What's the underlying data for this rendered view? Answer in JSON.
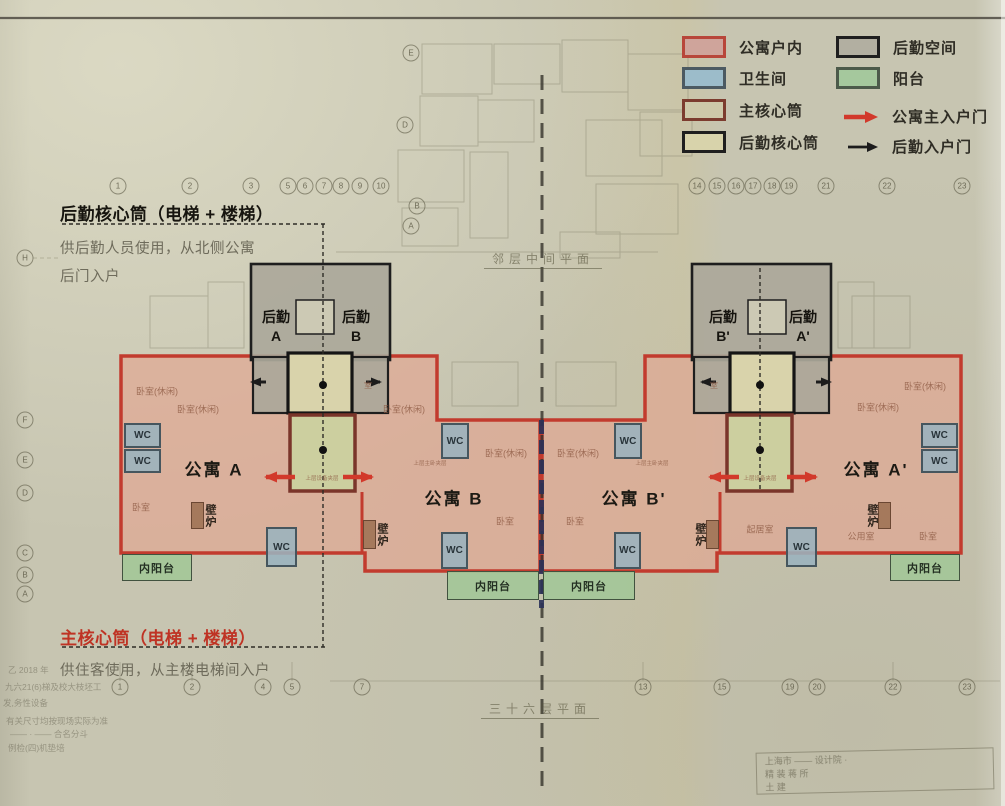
{
  "legend": {
    "items": [
      {
        "name": "apartment-interior",
        "label": "公寓户内",
        "x": 682,
        "y": 36,
        "fill": "#cfa49b",
        "border": "#b8463a"
      },
      {
        "name": "service-space",
        "label": "后勤空间",
        "x": 836,
        "y": 36,
        "fill": "#b2afa1",
        "border": "#1f1f1f"
      },
      {
        "name": "bathroom",
        "label": "卫生间",
        "x": 682,
        "y": 67,
        "fill": "#9cbcca",
        "border": "#4c5a62"
      },
      {
        "name": "balcony",
        "label": "阳台",
        "x": 836,
        "y": 67,
        "fill": "#a5c89d",
        "border": "#4c5a4a"
      },
      {
        "name": "main-core",
        "label": "主核心筒",
        "x": 682,
        "y": 99,
        "fill": "#cec9a9",
        "border": "#7c3c2e"
      },
      {
        "name": "service-core",
        "label": "后勤核心筒",
        "x": 682,
        "y": 131,
        "fill": "#d8d3ab",
        "border": "#1f1f1f"
      }
    ],
    "arrows": [
      {
        "name": "apartment-main-entry",
        "label": "公寓主入户门",
        "x": 843,
        "y": 106,
        "color": "#d2392b",
        "big": true
      },
      {
        "name": "service-entry",
        "label": "后勤入户门",
        "x": 847,
        "y": 136,
        "color": "#1c1c1c",
        "big": false
      }
    ]
  },
  "annotations": {
    "service_core": {
      "title": "后勤核心筒（电梯 + 楼梯）",
      "line1": "供后勤人员使用，从北侧公寓",
      "line2": "后门入户"
    },
    "main_core": {
      "title": "主核心筒（电梯 + 楼梯）",
      "line1": "供住客使用，从主楼电梯间入户"
    }
  },
  "plan": {
    "apartment_labels": [
      {
        "t": "公寓 A",
        "x": 214,
        "y": 468
      },
      {
        "t": "公寓 B",
        "x": 454,
        "y": 497
      },
      {
        "t": "公寓 B'",
        "x": 634,
        "y": 497
      },
      {
        "t": "公寓 A'",
        "x": 876,
        "y": 468
      }
    ],
    "service_labels": [
      {
        "l1": "后勤",
        "l2": "A",
        "x": 276,
        "y": 327
      },
      {
        "l1": "后勤",
        "l2": "B",
        "x": 356,
        "y": 327
      },
      {
        "l1": "后勤",
        "l2": "B'",
        "x": 723,
        "y": 327
      },
      {
        "l1": "后勤",
        "l2": "A'",
        "x": 803,
        "y": 327
      }
    ],
    "wc_label": "WC",
    "wc_boxes": [
      {
        "x": 124,
        "y": 423,
        "w": 37,
        "h": 25
      },
      {
        "x": 124,
        "y": 449,
        "w": 37,
        "h": 24
      },
      {
        "x": 266,
        "y": 527,
        "w": 31,
        "h": 40
      },
      {
        "x": 441,
        "y": 423,
        "w": 28,
        "h": 36
      },
      {
        "x": 441,
        "y": 532,
        "w": 27,
        "h": 37
      },
      {
        "x": 614,
        "y": 423,
        "w": 28,
        "h": 36
      },
      {
        "x": 614,
        "y": 532,
        "w": 27,
        "h": 37
      },
      {
        "x": 921,
        "y": 423,
        "w": 37,
        "h": 25
      },
      {
        "x": 921,
        "y": 449,
        "w": 37,
        "h": 24
      },
      {
        "x": 786,
        "y": 527,
        "w": 31,
        "h": 40
      }
    ],
    "balcony_label": "内阳台",
    "balconies": [
      {
        "x": 122,
        "y": 554,
        "w": 70,
        "h": 27
      },
      {
        "x": 447,
        "y": 571,
        "w": 92,
        "h": 29
      },
      {
        "x": 543,
        "y": 571,
        "w": 92,
        "h": 29
      },
      {
        "x": 890,
        "y": 554,
        "w": 70,
        "h": 27
      }
    ],
    "fireplace_label": "壁炉",
    "fireplaces": [
      {
        "x": 191,
        "y": 502,
        "w": 13,
        "h": 27,
        "tx": 210,
        "ty": 516
      },
      {
        "x": 363,
        "y": 520,
        "w": 13,
        "h": 29,
        "tx": 382,
        "ty": 535
      },
      {
        "x": 706,
        "y": 520,
        "w": 13,
        "h": 29,
        "tx": 700,
        "ty": 535
      },
      {
        "x": 878,
        "y": 502,
        "w": 13,
        "h": 27,
        "tx": 872,
        "ty": 516
      }
    ],
    "room_labels": [
      {
        "t": "卧室(休闲)",
        "x": 157,
        "y": 391
      },
      {
        "t": "卧室(休闲)",
        "x": 198,
        "y": 409
      },
      {
        "t": "卧室",
        "x": 141,
        "y": 507
      },
      {
        "t": "卧室(休闲)",
        "x": 404,
        "y": 409
      },
      {
        "t": "卧室(休闲)",
        "x": 506,
        "y": 453
      },
      {
        "t": "卧室",
        "x": 505,
        "y": 521
      },
      {
        "t": "卧室(休闲)",
        "x": 578,
        "y": 453
      },
      {
        "t": "卧室",
        "x": 575,
        "y": 521
      },
      {
        "t": "起居室",
        "x": 760,
        "y": 529
      },
      {
        "t": "卧室(休闲)",
        "x": 925,
        "y": 386
      },
      {
        "t": "卧室(休闲)",
        "x": 878,
        "y": 407
      },
      {
        "t": "公用室",
        "x": 861,
        "y": 536
      },
      {
        "t": "卧室",
        "x": 928,
        "y": 536
      },
      {
        "t": "上层设备夹层",
        "x": 322,
        "y": 478,
        "s": 5.5
      },
      {
        "t": "上层设备夹层",
        "x": 760,
        "y": 478,
        "s": 5.5
      },
      {
        "t": "上层主卧夹层",
        "x": 430,
        "y": 463,
        "s": 5.5
      },
      {
        "t": "上层主卧夹层",
        "x": 652,
        "y": 463,
        "s": 5.5
      },
      {
        "t": "室",
        "x": 368,
        "y": 385,
        "s": 8,
        "v": true
      },
      {
        "t": "室",
        "x": 714,
        "y": 385,
        "s": 8,
        "v": true
      }
    ],
    "grid_bubbles": [
      {
        "t": "1",
        "x": 118,
        "y": 186
      },
      {
        "t": "2",
        "x": 190,
        "y": 186
      },
      {
        "t": "3",
        "x": 251,
        "y": 186
      },
      {
        "t": "5",
        "x": 288,
        "y": 186
      },
      {
        "t": "6",
        "x": 305,
        "y": 186
      },
      {
        "t": "7",
        "x": 324,
        "y": 186
      },
      {
        "t": "8",
        "x": 341,
        "y": 186
      },
      {
        "t": "9",
        "x": 360,
        "y": 186
      },
      {
        "t": "10",
        "x": 381,
        "y": 186
      },
      {
        "t": "14",
        "x": 697,
        "y": 186
      },
      {
        "t": "15",
        "x": 717,
        "y": 186
      },
      {
        "t": "16",
        "x": 736,
        "y": 186
      },
      {
        "t": "17",
        "x": 753,
        "y": 186
      },
      {
        "t": "18",
        "x": 772,
        "y": 186
      },
      {
        "t": "19",
        "x": 789,
        "y": 186
      },
      {
        "t": "21",
        "x": 826,
        "y": 186
      },
      {
        "t": "22",
        "x": 887,
        "y": 186
      },
      {
        "t": "23",
        "x": 962,
        "y": 186
      },
      {
        "t": "1",
        "x": 120,
        "y": 687
      },
      {
        "t": "2",
        "x": 192,
        "y": 687
      },
      {
        "t": "4",
        "x": 263,
        "y": 687
      },
      {
        "t": "5",
        "x": 292,
        "y": 687
      },
      {
        "t": "7",
        "x": 362,
        "y": 687
      },
      {
        "t": "13",
        "x": 643,
        "y": 687
      },
      {
        "t": "15",
        "x": 722,
        "y": 687
      },
      {
        "t": "19",
        "x": 790,
        "y": 687
      },
      {
        "t": "20",
        "x": 817,
        "y": 687
      },
      {
        "t": "22",
        "x": 893,
        "y": 687
      },
      {
        "t": "23",
        "x": 967,
        "y": 687
      },
      {
        "t": "H",
        "x": 25,
        "y": 258
      },
      {
        "t": "F",
        "x": 25,
        "y": 420
      },
      {
        "t": "E",
        "x": 25,
        "y": 460
      },
      {
        "t": "D",
        "x": 25,
        "y": 493
      },
      {
        "t": "C",
        "x": 25,
        "y": 553
      },
      {
        "t": "B",
        "x": 25,
        "y": 575
      },
      {
        "t": "A",
        "x": 25,
        "y": 594
      },
      {
        "t": "E",
        "x": 411,
        "y": 53
      },
      {
        "t": "D",
        "x": 405,
        "y": 125
      },
      {
        "t": "B",
        "x": 417,
        "y": 206
      },
      {
        "t": "A",
        "x": 411,
        "y": 226
      }
    ],
    "titles": {
      "upper": "邻层中间平面",
      "lower": "三十六层平面"
    },
    "notes": [
      {
        "t": "乙 2018 年",
        "x": 8,
        "y": 664
      },
      {
        "t": "九六21(6)梯及校大枝坯工",
        "x": 5,
        "y": 681
      },
      {
        "t": "发,务性设备",
        "x": 3,
        "y": 697
      },
      {
        "t": "有关尺寸均按现场实际为准",
        "x": 6,
        "y": 715
      },
      {
        "t": "—— · —— 合名分斗",
        "x": 10,
        "y": 728
      },
      {
        "t": "例检(四)机垫培",
        "x": 8,
        "y": 742
      }
    ],
    "title_block": [
      "上海市 —— 设计院  ·",
      "精 装 蒋 所",
      "土 建"
    ]
  }
}
